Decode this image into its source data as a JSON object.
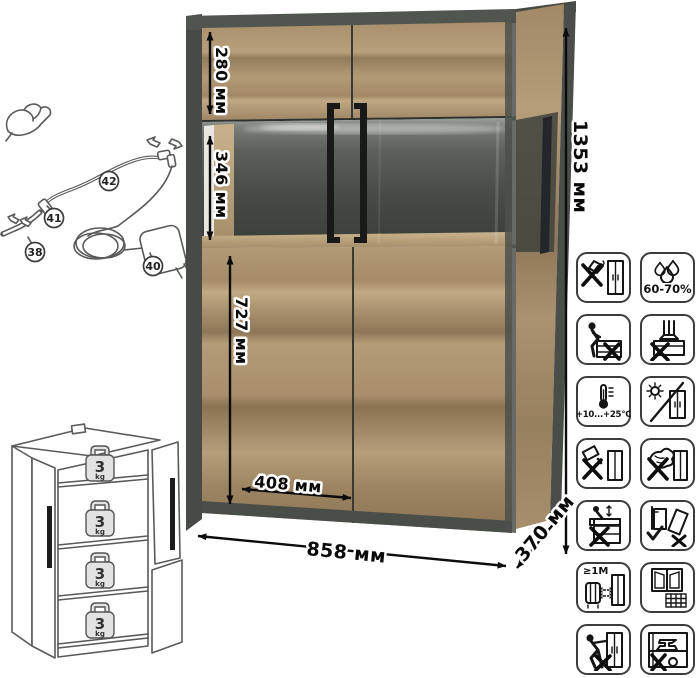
{
  "dimensions": {
    "height_label": "1353 мм",
    "width_label": "858 мм",
    "depth_label": "370 мм",
    "top_section_label": "280 мм",
    "glass_section_label": "346 мм",
    "bottom_section_label": "727 мм",
    "door_width_label": "408 мм"
  },
  "cable_diagram": {
    "part_38": "38",
    "part_40": "40",
    "part_41": "41",
    "part_42": "42"
  },
  "shelf_diagram": {
    "weights": [
      {
        "value": "3",
        "unit": "kg"
      },
      {
        "value": "3",
        "unit": "kg"
      },
      {
        "value": "3",
        "unit": "kg"
      },
      {
        "value": "3",
        "unit": "kg"
      }
    ]
  },
  "care_icons": [
    {
      "name": "no-sharp-tools",
      "label": ""
    },
    {
      "name": "humidity-range",
      "label": "60-70%"
    },
    {
      "name": "no-sitting",
      "label": ""
    },
    {
      "name": "no-standing",
      "label": ""
    },
    {
      "name": "temperature-range",
      "label": "+10...+25°C"
    },
    {
      "name": "no-direct-sunlight",
      "label": ""
    },
    {
      "name": "no-spilling-liquids",
      "label": ""
    },
    {
      "name": "no-abrasive-cleaners",
      "label": ""
    },
    {
      "name": "no-climbing",
      "label": ""
    },
    {
      "name": "anchor-to-wall",
      "label": ""
    },
    {
      "name": "heat-source-distance",
      "label": "≥1M"
    },
    {
      "name": "ventilate-room",
      "label": ""
    },
    {
      "name": "no-dragging",
      "label": ""
    },
    {
      "name": "no-heavy-items",
      "label": ""
    }
  ],
  "colors": {
    "wood_light": "#b79e79",
    "wood_dark": "#8d7758",
    "frame_dark": "#4a4e49",
    "glass_dark": "#3f433e",
    "handle": "#1a1a1a",
    "line_art": "#5a5a5a",
    "dimension_text": "#0a0a0a"
  }
}
